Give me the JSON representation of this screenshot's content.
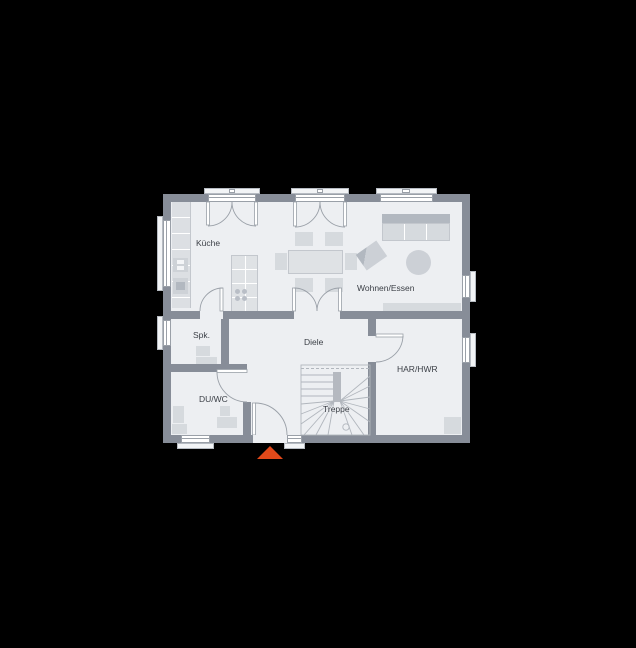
{
  "scene": {
    "background": "#000000"
  },
  "floorplan": {
    "type": "floor-plan",
    "floor_name": "ground-floor",
    "labels": {
      "kueche": "Küche",
      "spk": "Spk.",
      "duwc": "DU/WC",
      "diele": "Diele",
      "treppe": "Treppe",
      "wohnen": "Wohnen/Essen",
      "har": "HAR/HWR"
    },
    "colors": {
      "bg": "#000000",
      "wall": "#878d98",
      "floor": "#edeff2",
      "furn": "#d6dade",
      "furn-dark": "#b2b8c0",
      "furn-border": "#c3c7cd",
      "line": "#9aa0a8",
      "stair": "#b1b6bd",
      "sill": "#f2f4f6",
      "sill-border": "#b6bbc2",
      "text": "#3b3f46",
      "accent": "#e2491a"
    }
  }
}
